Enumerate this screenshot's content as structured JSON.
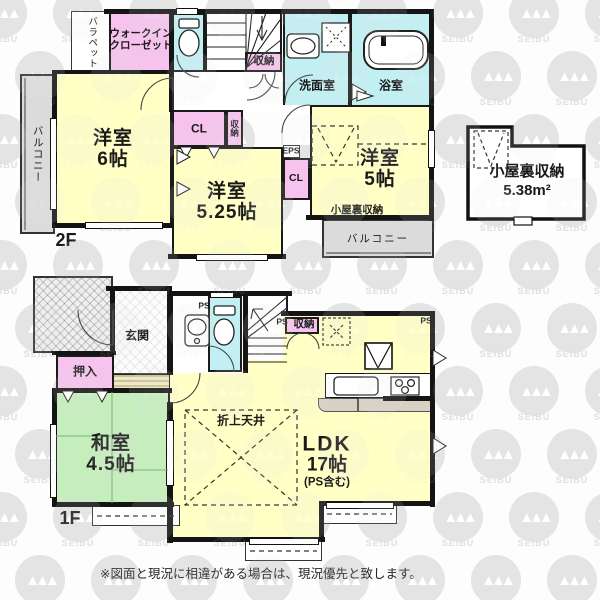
{
  "watermark": {
    "text": "SEIBU"
  },
  "colors": {
    "room_yellow": "#FFFFC6",
    "closet_pink": "#F6C2EE",
    "wet_cyan": "#C2EFF2",
    "tatami_green": "#C6EDBC",
    "balcony_gray": "#DBDBDB",
    "counter_gray": "#D6D1C4",
    "white": "#FFFFFF"
  },
  "f2": {
    "floor_label": "2F",
    "balcony_left": "バルコニー",
    "parapet": "バラペット",
    "wic": [
      "ウォークイン",
      "クローゼット"
    ],
    "stairs_storage": "収納",
    "washroom": "洗面室",
    "bathroom": "浴室",
    "room6": {
      "name": "洋室",
      "size": "6帖"
    },
    "cl_left": "CL",
    "storage_mid": "収納",
    "room525": {
      "name": "洋室",
      "size": "5.25帖"
    },
    "eps": "EPS",
    "cl_right": "CL",
    "room5": {
      "name": "洋室",
      "size": "5帖"
    },
    "attic_access": "小屋裏収納",
    "balcony_right": "バルコニー"
  },
  "attic": {
    "name": "小屋裏収納",
    "size": "5.38m²"
  },
  "f1": {
    "floor_label": "1F",
    "genkan": "玄関",
    "ps_hall": "PS",
    "storage": "収納",
    "ps_storage": "PS",
    "ps_kitchen": "PS",
    "oshiire": "押入",
    "washitsu": {
      "name": "和室",
      "size": "4.5帖"
    },
    "ceiling": "折上天井",
    "ldk": {
      "name": "LDK",
      "size": "17帖",
      "note": "(PS含む)"
    }
  },
  "footer": {
    "disclaimer": "※図面と現況に相違がある場合は、現況優先と致します。"
  }
}
